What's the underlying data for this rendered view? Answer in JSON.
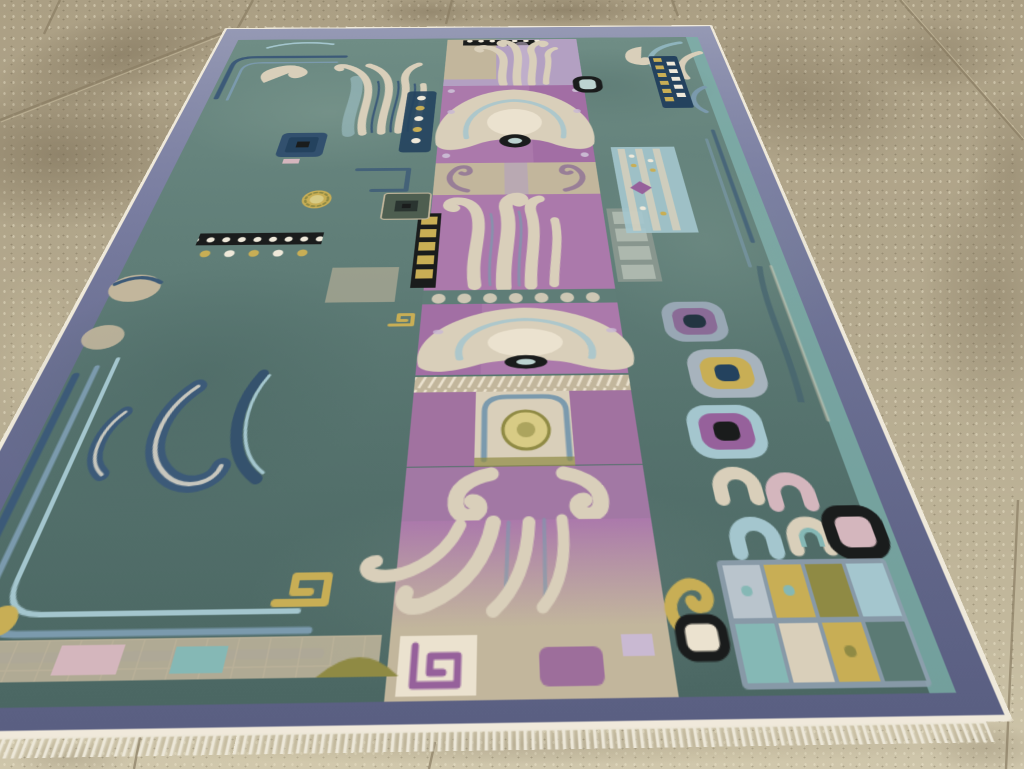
{
  "scene": {
    "type": "photograph",
    "subject": "antique pictorial carpet with archaic bronze-style motifs on a beige concrete tile floor",
    "view": "oblique; rug recedes toward the top of frame, fringe at near (bottom) edge"
  },
  "rug": {
    "border_style": "plain slate blue-violet border with white selvage and white fringe",
    "field_style": "mottled teal-green field, central orchid panels with cream fan medallions and flame plumes",
    "motifs": [
      "fan-palmette medallion with dark ring eye",
      "flame plume bundles",
      "C-scrolls and fret hooks",
      "black-and-white checker bands",
      "gold dot columns",
      "horseshoe scrolls",
      "colored grid squares",
      "wave swirls"
    ]
  },
  "palette": {
    "floor1": "#ab9f84",
    "floor2": "#b3a88d",
    "floor3": "#c2b89c",
    "floor4": "#cfc6ab",
    "grout": "#8a7d63",
    "groutHi": "#d3c8a9",
    "stain": "#695c45",
    "floorLight": "#dcd2b0",
    "fringe": "#ece7d8",
    "white": "#efe9da",
    "border1": "#9599b4",
    "border2": "#797da0",
    "border3": "#5a5f82",
    "field1": "#6f8d85",
    "field2": "#5f7d77",
    "field3": "#4b6763",
    "fieldHi": "#92ac9f",
    "fieldLo": "#3e5a57",
    "slate": "#3c5a78",
    "slateLt": "#7b9aad",
    "navy": "#24425e",
    "paleBlue": "#a4c6ce",
    "aqua": "#85b8b5",
    "ice": "#bcd3d0",
    "cream": "#d9cfba",
    "creamHi": "#ebe2cf",
    "creamLo": "#c2b69c",
    "lilac": "#b3a0c2",
    "lavender": "#c9b9d2",
    "orchid": "#ab79ab",
    "magenta": "#96619b",
    "plum": "#8a6b96",
    "pink": "#d4b6bd",
    "gold": "#c8ae55",
    "olive": "#8f8a44",
    "paleYellow": "#d8cb85",
    "black": "#1a1c1c"
  }
}
